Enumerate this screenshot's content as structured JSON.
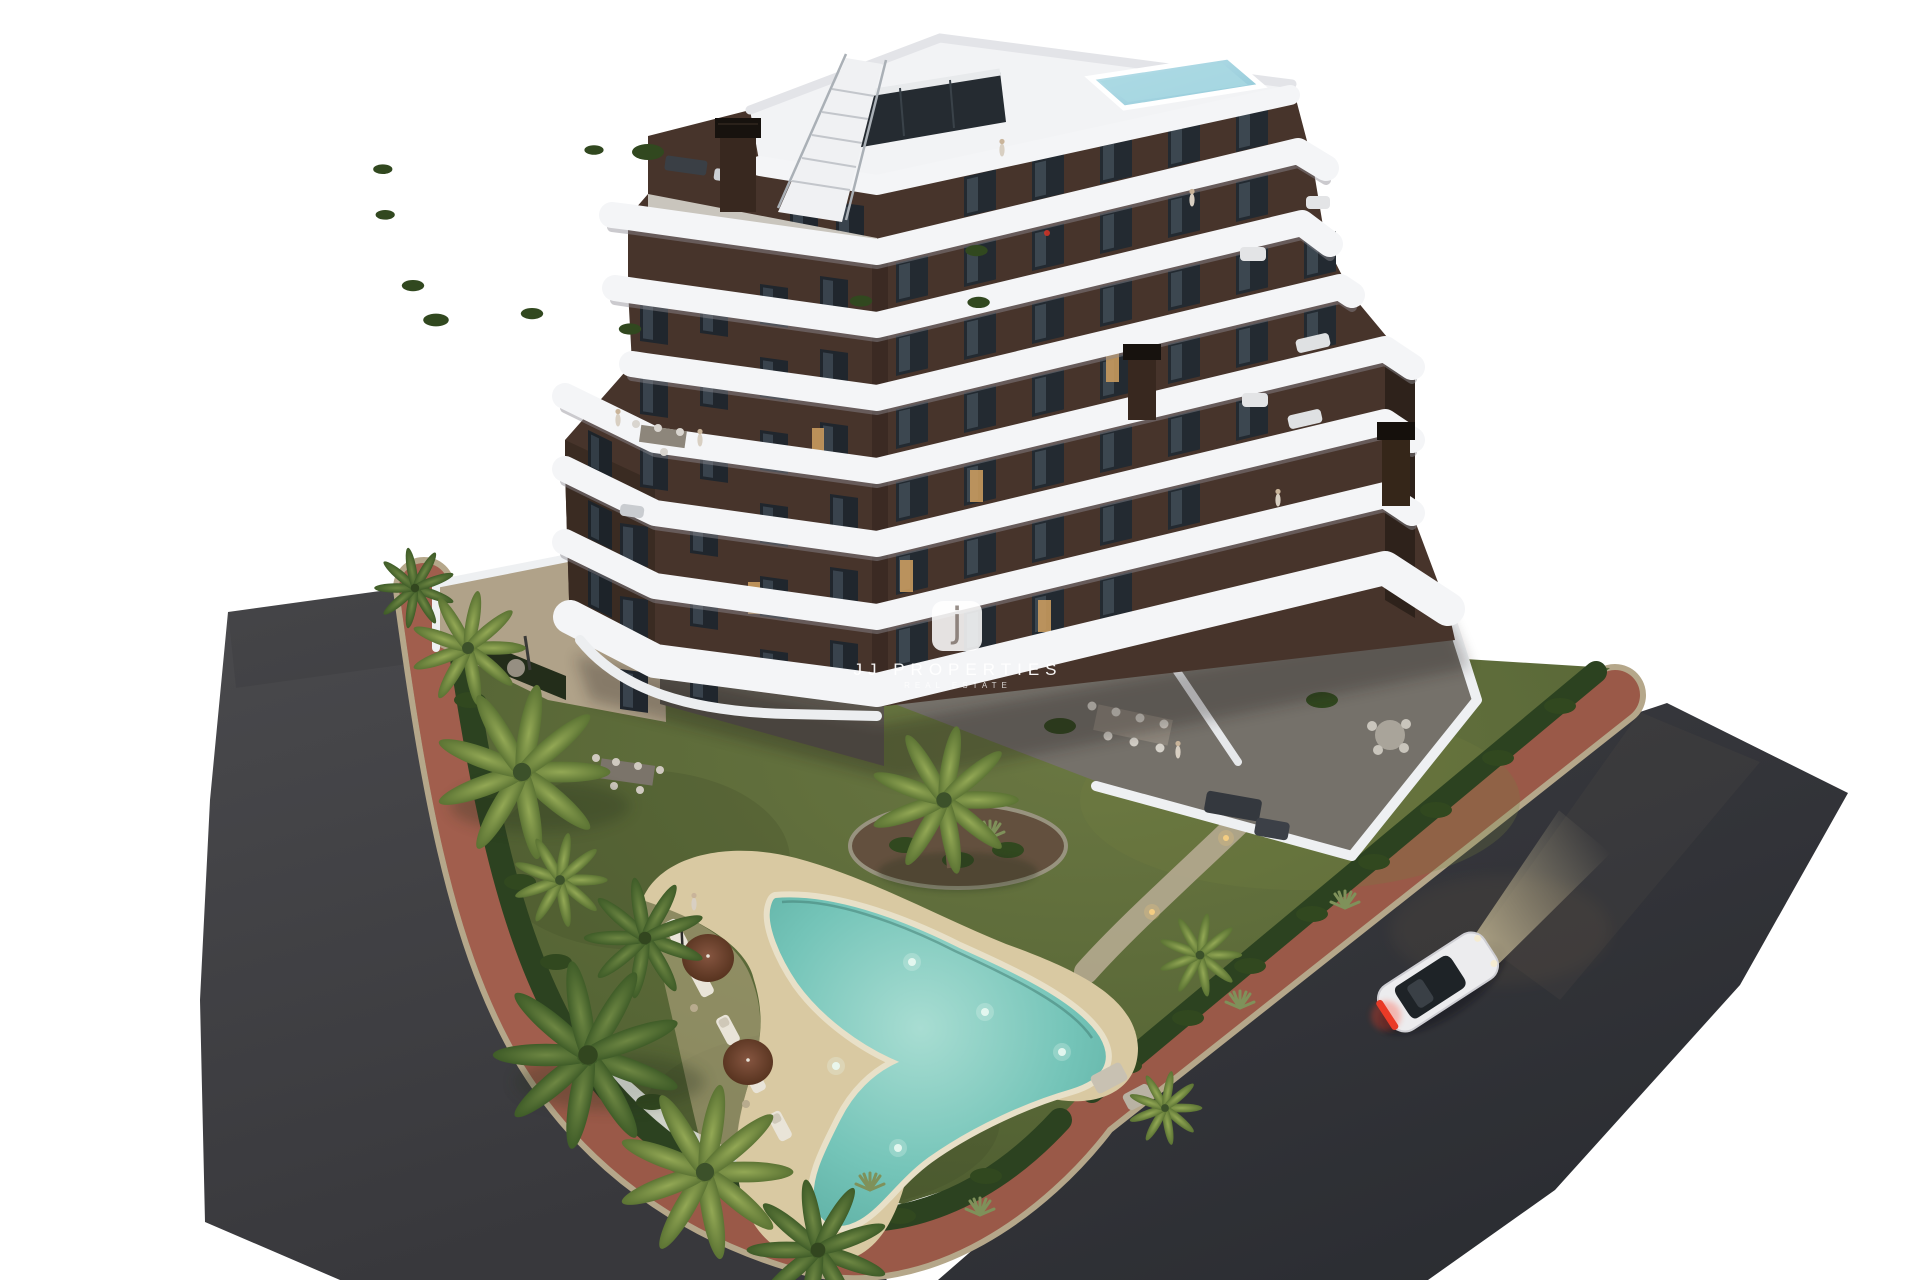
{
  "image": {
    "type": "3D architectural exterior render",
    "scene": "Modern apartment building with curved white wraparound balconies, rooftop pool and terraces, landscaped garden with free-form swimming pool, palm trees, perimeter asphalt roads with red paved sidewalk, and a white car with headlights on"
  },
  "watermark": {
    "logo_letter": "j",
    "brand": "JJ PROPERTIES",
    "tagline": "REAL ESTATE"
  },
  "palette": {
    "background": "#ffffff",
    "asphalt_left": "#414144",
    "asphalt_right": "#313338",
    "sidewalk_red": "#9a5948",
    "curb": "#b5a78a",
    "lawn": "#5d6c3a",
    "hedge": "#2c4220",
    "pool_water": "#74c4b8",
    "pool_deck": "#d9c9a2",
    "facade_brown": "#47342b",
    "facade_side": "#3a2b22",
    "balcony_white": "#f4f5f7",
    "window_glass": "#232a31",
    "window_glow": "#c89a5e",
    "palm_green": "#5f7d3c",
    "car_body": "#ececee",
    "taillight": "#e23a28",
    "headlight_glow": "#e9d8a8"
  }
}
